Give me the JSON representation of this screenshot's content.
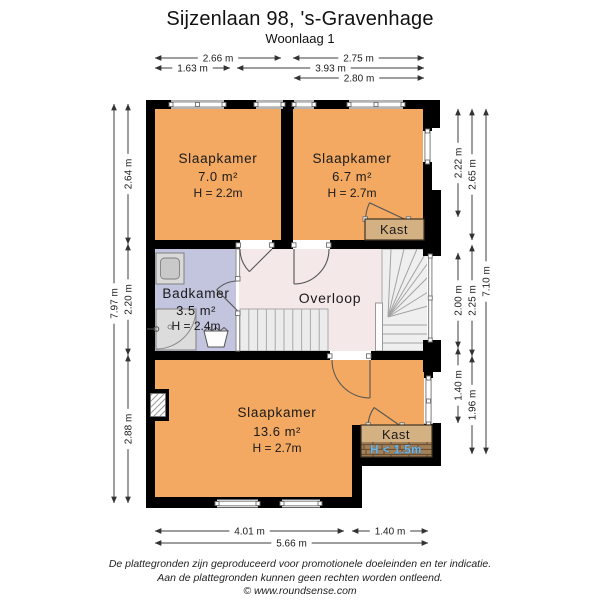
{
  "header": {
    "title": "Sijzenlaan 98, 's-Gravenhage",
    "subtitle": "Woonlaag 1"
  },
  "rooms": {
    "slaapkamer_tl": {
      "name": "Slaapkamer",
      "area": "7.0 m²",
      "height": "H = 2.2m"
    },
    "slaapkamer_tr": {
      "name": "Slaapkamer",
      "area": "6.7 m²",
      "height": "H = 2.7m"
    },
    "badkamer": {
      "name": "Badkamer",
      "area": "3.5 m²",
      "height": "H = 2.4m"
    },
    "overloop": {
      "name": "Overloop"
    },
    "slaapkamer_b": {
      "name": "Slaapkamer",
      "area": "13.6 m²",
      "height": "H = 2.7m"
    }
  },
  "closets": {
    "top": {
      "label": "Kast"
    },
    "bottom": {
      "label": "Kast",
      "height_note": "H < 1.5m"
    }
  },
  "dimension_lines": [
    {
      "label": "2.66 m",
      "x1": 155,
      "y1": 58,
      "x2": 281,
      "y2": 58
    },
    {
      "label": "2.75 m",
      "x1": 293,
      "y1": 58,
      "x2": 424,
      "y2": 58
    },
    {
      "label": "1.63 m",
      "x1": 155,
      "y1": 68,
      "x2": 230,
      "y2": 68
    },
    {
      "label": "3.93 m",
      "x1": 237,
      "y1": 68,
      "x2": 424,
      "y2": 68
    },
    {
      "label": "2.80 m",
      "x1": 294,
      "y1": 78,
      "x2": 424,
      "y2": 78
    },
    {
      "label": "7.97 m",
      "x1": 114,
      "y1": 104,
      "x2": 114,
      "y2": 503,
      "v": true
    },
    {
      "label": "2.64 m",
      "x1": 128,
      "y1": 104,
      "x2": 128,
      "y2": 244,
      "v": true
    },
    {
      "label": "2.20 m",
      "x1": 128,
      "y1": 244,
      "x2": 128,
      "y2": 355,
      "v": true
    },
    {
      "label": "2.88 m",
      "x1": 128,
      "y1": 355,
      "x2": 128,
      "y2": 503,
      "v": true
    },
    {
      "label": "2.22 m",
      "x1": 458,
      "y1": 109,
      "x2": 458,
      "y2": 217,
      "v": true
    },
    {
      "label": "2.00 m",
      "x1": 458,
      "y1": 253,
      "x2": 458,
      "y2": 348,
      "v": true
    },
    {
      "label": "1.40 m",
      "x1": 458,
      "y1": 348,
      "x2": 458,
      "y2": 423,
      "v": true
    },
    {
      "label": "2.65 m",
      "x1": 472,
      "y1": 109,
      "x2": 472,
      "y2": 240,
      "v": true
    },
    {
      "label": "2.25 m",
      "x1": 472,
      "y1": 245,
      "x2": 472,
      "y2": 356,
      "v": true
    },
    {
      "label": "1.96 m",
      "x1": 472,
      "y1": 356,
      "x2": 472,
      "y2": 454,
      "v": true
    },
    {
      "label": "7.10 m",
      "x1": 486,
      "y1": 109,
      "x2": 486,
      "y2": 454,
      "v": true
    },
    {
      "label": "4.01 m",
      "x1": 155,
      "y1": 531,
      "x2": 344,
      "y2": 531
    },
    {
      "label": "1.40 m",
      "x1": 352,
      "y1": 531,
      "x2": 428,
      "y2": 531
    },
    {
      "label": "5.66 m",
      "x1": 155,
      "y1": 543,
      "x2": 428,
      "y2": 543
    }
  ],
  "footer": {
    "line1": "De plattegronden zijn geproduceerd voor promotionele doeleinden en ter indicatie.",
    "line2": "Aan de plattegronden kunnen geen rechten worden ontleend.",
    "line3": "© www.roundsense.com"
  },
  "colors": {
    "bedroom": "#f3a961",
    "bathroom": "#c2c5dd",
    "landing": "#f4e8e8",
    "closet": "#d4b183",
    "wall": "#000000",
    "stairs": "#eeeeee",
    "kast_height_text": "#6fb7e8"
  }
}
